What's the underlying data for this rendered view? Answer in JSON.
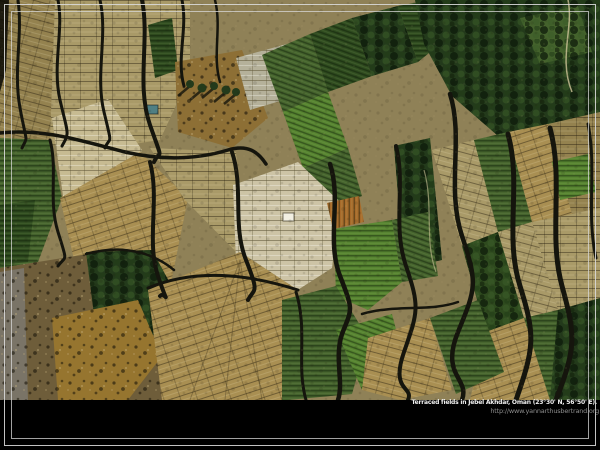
{
  "caption": {
    "title": "Terraced fields in Jebel Akhdar, Oman (23°30' N, 56°50' E).",
    "url": "http://www.yannarthusbertrand.org"
  },
  "palette": {
    "frame-line": "#d8d8d8",
    "caption-band": "#000000",
    "caption-text": "#f0f0f0",
    "caption-url": "#8c8c8c",
    "base-tan": "#8f8157",
    "tan": "#a99a68",
    "tan-dark": "#94824f",
    "gold": "#a98f52",
    "beige": "#c7bb92",
    "beige-bright": "#cdc4a6",
    "gray-terrace": "#b5b19a",
    "green-bright": "#55822f",
    "green": "#44622c",
    "green-dark": "#2e4a1e",
    "tree-dark": "#233a1b",
    "ochre": "#8d6f35",
    "rust": "#a76a2a",
    "rock": "#6e5d3a",
    "rock-ochre": "#96752f",
    "rock-gray": "#7a7467",
    "pool-blue": "#4f7f83",
    "building-white": "#f2efe2",
    "shadow-line": "#15150d",
    "path-light": "#cfc49a"
  }
}
